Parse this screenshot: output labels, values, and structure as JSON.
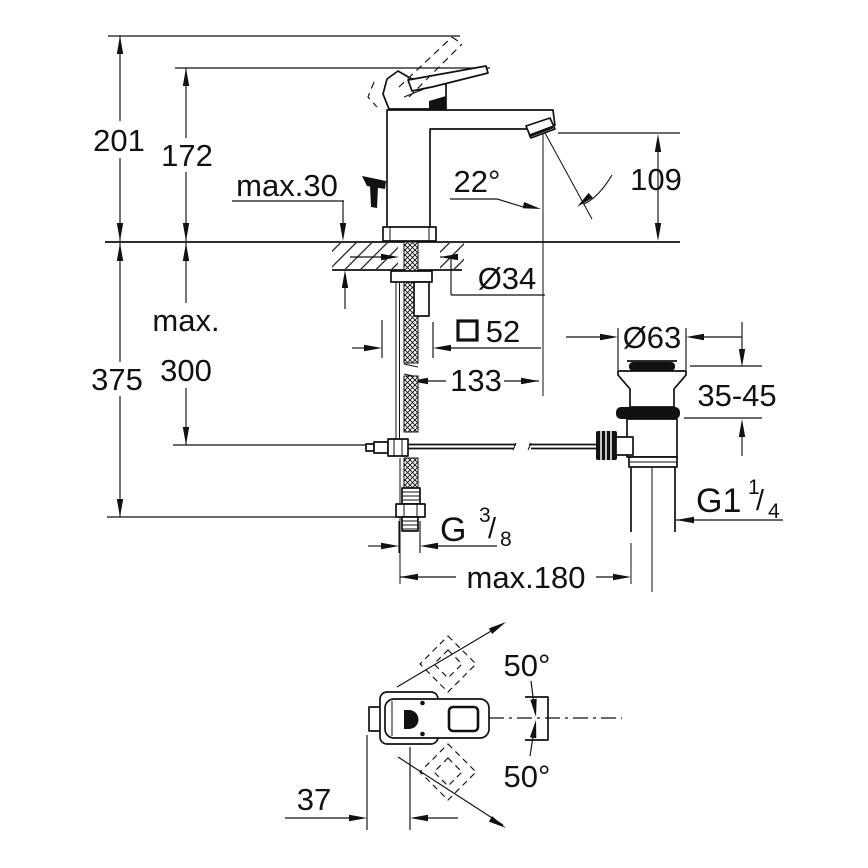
{
  "drawing": {
    "type": "technical-dimension-drawing",
    "product": "single-lever basin mixer with pop-up waste",
    "colors": {
      "line": "#111111",
      "background": "#ffffff"
    },
    "side_view": {
      "overall_height": "201",
      "body_height": "172",
      "deck_thickness_max": "max.30",
      "spray_angle": "22°",
      "spout_height": "109",
      "mounting_hole_diameter": "Ø34",
      "base_square_symbol": "□",
      "base_square_size": "52",
      "spout_projection": "133",
      "max_word": "max.",
      "rod_depth_max": "300",
      "supply_depth": "375",
      "waste_flange_diameter": "Ø63",
      "deck_thickness_range": "35-45",
      "supply_thread_main": "G",
      "supply_thread_sup": "3",
      "supply_thread_slash": "/",
      "supply_thread_sub": "8",
      "waste_thread_main": "G1",
      "waste_thread_sup": "1",
      "waste_thread_slash": "/",
      "waste_thread_sub": "4",
      "rod_reach_max": "max.180"
    },
    "plan_view": {
      "handle_swing_upper": "50°",
      "handle_swing_lower": "50°",
      "handle_offset": "37"
    }
  }
}
